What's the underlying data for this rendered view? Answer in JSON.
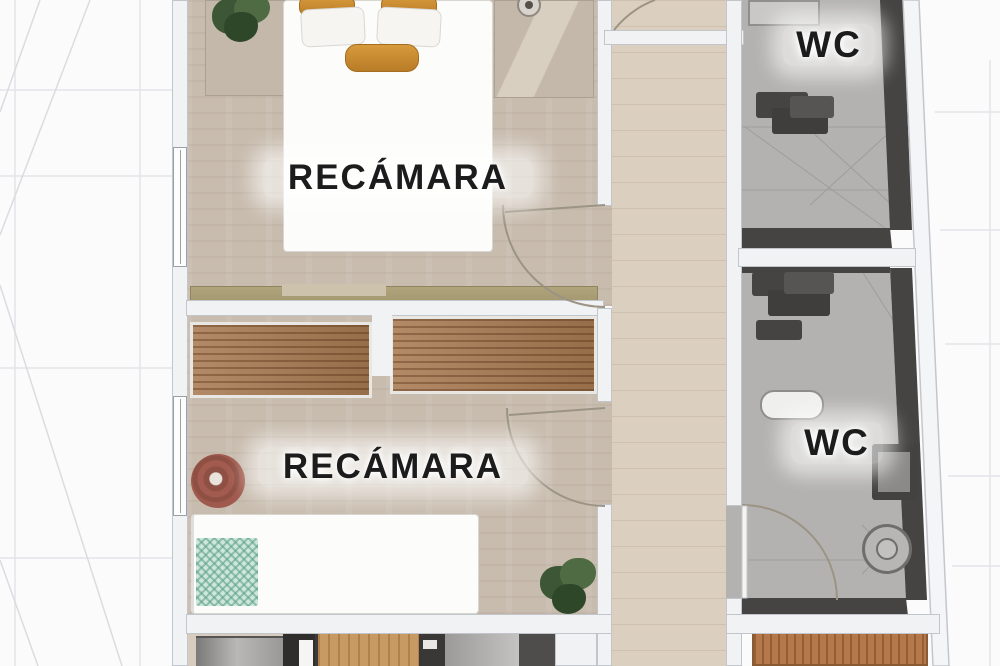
{
  "floor_plan": {
    "rooms": [
      {
        "id": "bedroom-1",
        "label": "RECÁMARA"
      },
      {
        "id": "bedroom-2",
        "label": "RECÁMARA"
      },
      {
        "id": "wc-1",
        "label": "WC"
      },
      {
        "id": "wc-2",
        "label": "WC"
      }
    ],
    "palette": {
      "background": "#fbfbfc",
      "grid_line": "#e4e5e9",
      "wall_light": "#f1f2f4",
      "wall_dark": "#454442",
      "bedroom_floor": "#c8bcae",
      "corridor_floor": "#dbcfbf",
      "wc_floor": "#b4b2b0",
      "wood_wardrobe": "#a87a52",
      "wood_dresser": "#b5784a",
      "accent_pillow": "#c98c33",
      "teal_blanket": "#9ec7b5",
      "pouf": "#a05a4d",
      "plant": "#44603c",
      "label_text": "#1c1c1c"
    }
  }
}
